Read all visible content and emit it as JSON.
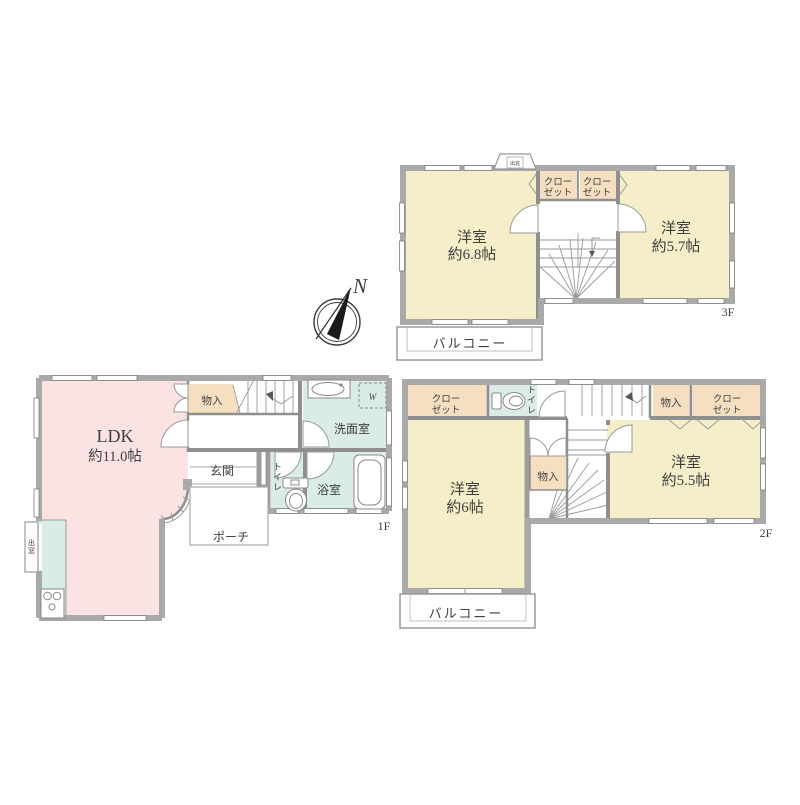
{
  "palette": {
    "wall_gray": "#a9a9a9",
    "room_cream": "#f5eec9",
    "room_peach": "#f6dfc0",
    "room_pink": "#fae3e2",
    "room_teal": "#daece6",
    "line_gray": "#8f8f8f",
    "text_gray": "#3f3f3f",
    "background": "#ffffff"
  },
  "compass": {
    "north_label": "N"
  },
  "floor_3f": {
    "floor_label": "3F",
    "bay_window_label": "出窓",
    "room_west": {
      "name": "洋室",
      "size": "約6.8帖"
    },
    "room_east": {
      "name": "洋室",
      "size": "約5.7帖"
    },
    "closet_west": {
      "line1": "クロー",
      "line2": "ゼット"
    },
    "closet_east": {
      "line1": "クロー",
      "line2": "ゼット"
    },
    "balcony_label": "バルコニー"
  },
  "floor_2f": {
    "floor_label": "2F",
    "closet_northwest": {
      "line1": "クロー",
      "line2": "ゼット"
    },
    "toilet_label": "トイレ",
    "storage_north": "物入",
    "closet_northeast": {
      "line1": "クロー",
      "line2": "ゼット"
    },
    "room_west": {
      "name": "洋室",
      "size": "約6帖"
    },
    "storage_center": "物入",
    "room_east": {
      "name": "洋室",
      "size": "約5.5帖"
    },
    "balcony_label": "バルコニー"
  },
  "floor_1f": {
    "floor_label": "1F",
    "ldk": {
      "name": "LDK",
      "size": "約11.0帖"
    },
    "storage_label": "物入",
    "entrance_label": "玄関",
    "washroom_label": "洗面室",
    "washer_label": "W",
    "toilet_label": "トイレ",
    "bathroom_label": "浴室",
    "porch_label": "ポーチ",
    "bay_window_label": "出窓"
  },
  "icons": {
    "compass": "compass-north-icon",
    "toilet": "toilet-icon",
    "bathtub": "bathtub-icon",
    "washbasin": "washbasin-icon",
    "stove": "stove-icon",
    "washer_space": "washer-dashed-box"
  }
}
